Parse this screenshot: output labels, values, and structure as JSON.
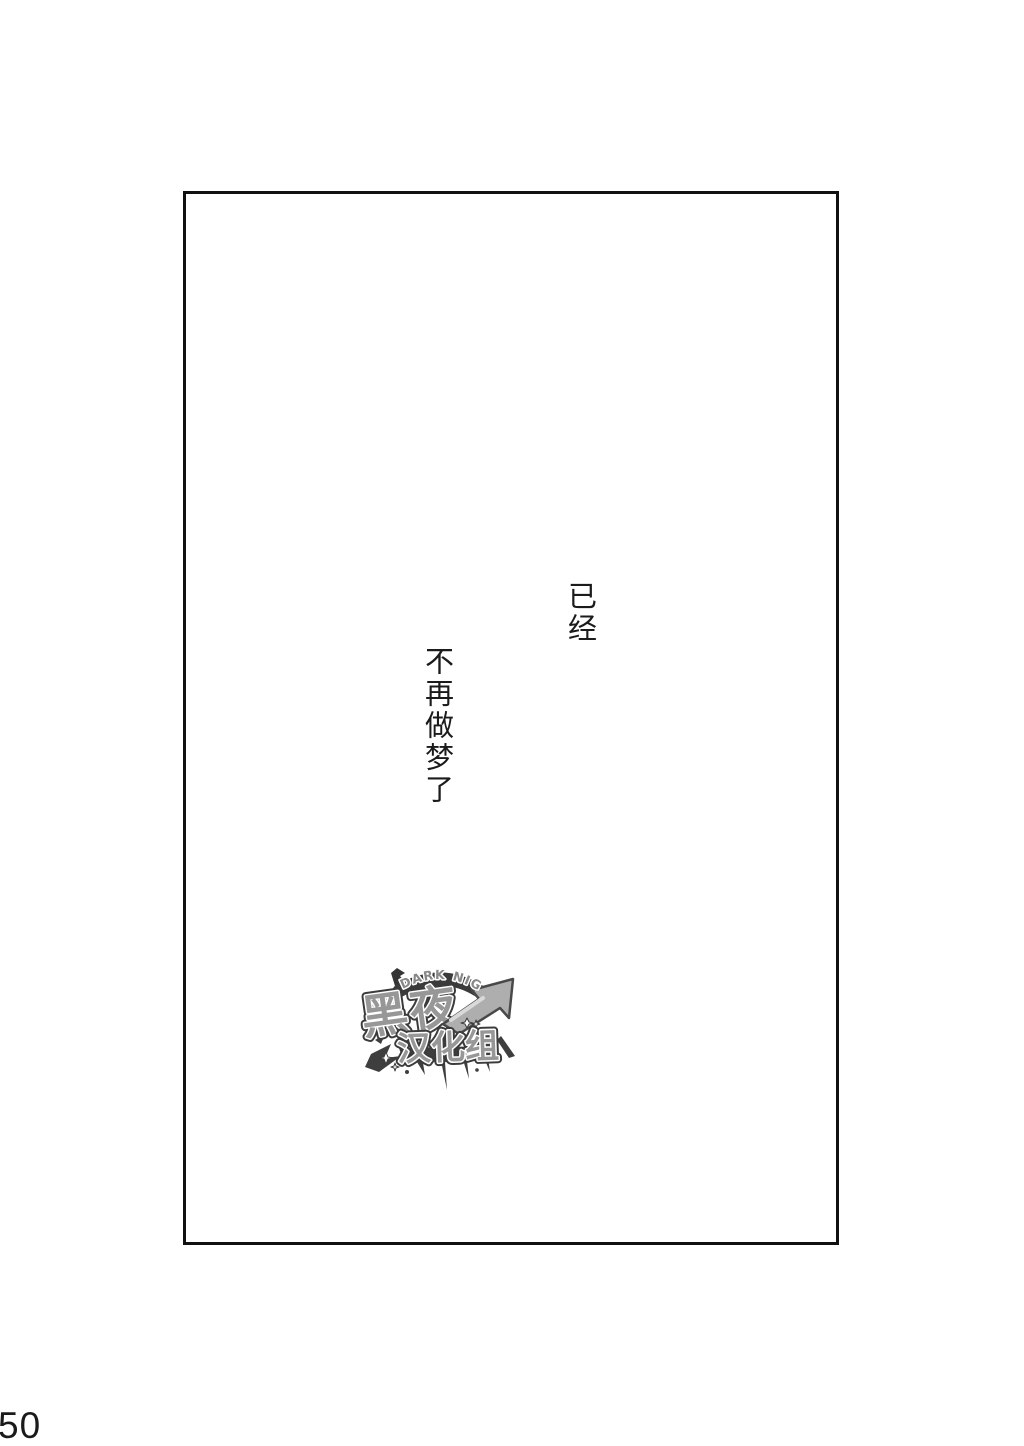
{
  "page": {
    "number": "50"
  },
  "panel": {
    "dialogue_line_1": "已经",
    "dialogue_line_2": "不再做梦了"
  },
  "watermark": {
    "arc_text": "DARK NIGHT",
    "group_name": "黑夜",
    "group_suffix": "汉化组",
    "colors": {
      "outline": "#2b2b2b",
      "fill": "#8f8f8f",
      "arrow_fill": "#a8a8a8",
      "arrow_highlight": "#d6d6d6"
    }
  },
  "colors": {
    "background": "#ffffff",
    "frame_border": "#111111",
    "ink": "#1b1b1b"
  }
}
